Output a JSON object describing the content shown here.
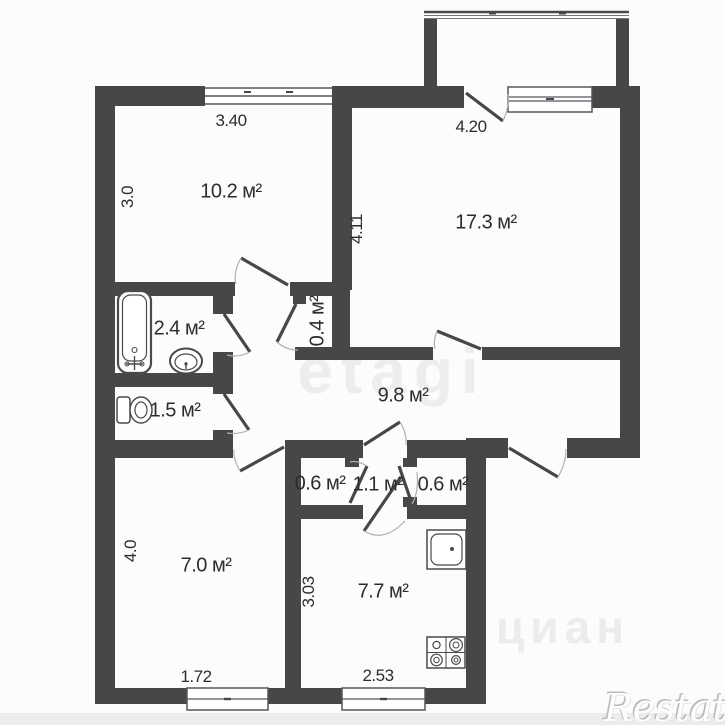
{
  "plan_title": "apartment-floor-plan",
  "rooms": {
    "top_left": {
      "area": "10.2 м²"
    },
    "top_right": {
      "area": "17.3 м²"
    },
    "bathroom": {
      "area": "2.4 м²"
    },
    "toilet": {
      "area": "1.5 м²"
    },
    "closet": {
      "area": "0.4 м²"
    },
    "hallway": {
      "area": "9.8 м²"
    },
    "bottom_left": {
      "area": "7.0 м²"
    },
    "kitchen": {
      "area": "7.7 м²"
    },
    "storage_left": {
      "area": "0.6 м²"
    },
    "vestibule": {
      "area": "1.1 м²"
    },
    "storage_right": {
      "area": "0.6 м²"
    }
  },
  "dimensions": {
    "top_left_width": "3.40",
    "top_left_depth": "3.0",
    "top_right_width": "4.20",
    "top_right_depth": "4.11",
    "bottom_left_depth": "4.0",
    "bottom_left_window": "1.72",
    "kitchen_depth": "3.03",
    "kitchen_window": "2.53"
  },
  "watermarks": {
    "center": "etagi",
    "bottom_right": "циан",
    "corner_logo": "Restate"
  },
  "icons": {
    "fixtures": [
      "bathtub-icon",
      "bath-sink-icon",
      "toilet-icon",
      "kitchen-sink-icon",
      "stove-icon"
    ]
  },
  "colors": {
    "wall": "#47474a",
    "label_text": "#2d2d2f",
    "door_arc": "#b0b0b0",
    "watermark_gray": "#ecedec",
    "background": "#fcfcfb"
  }
}
